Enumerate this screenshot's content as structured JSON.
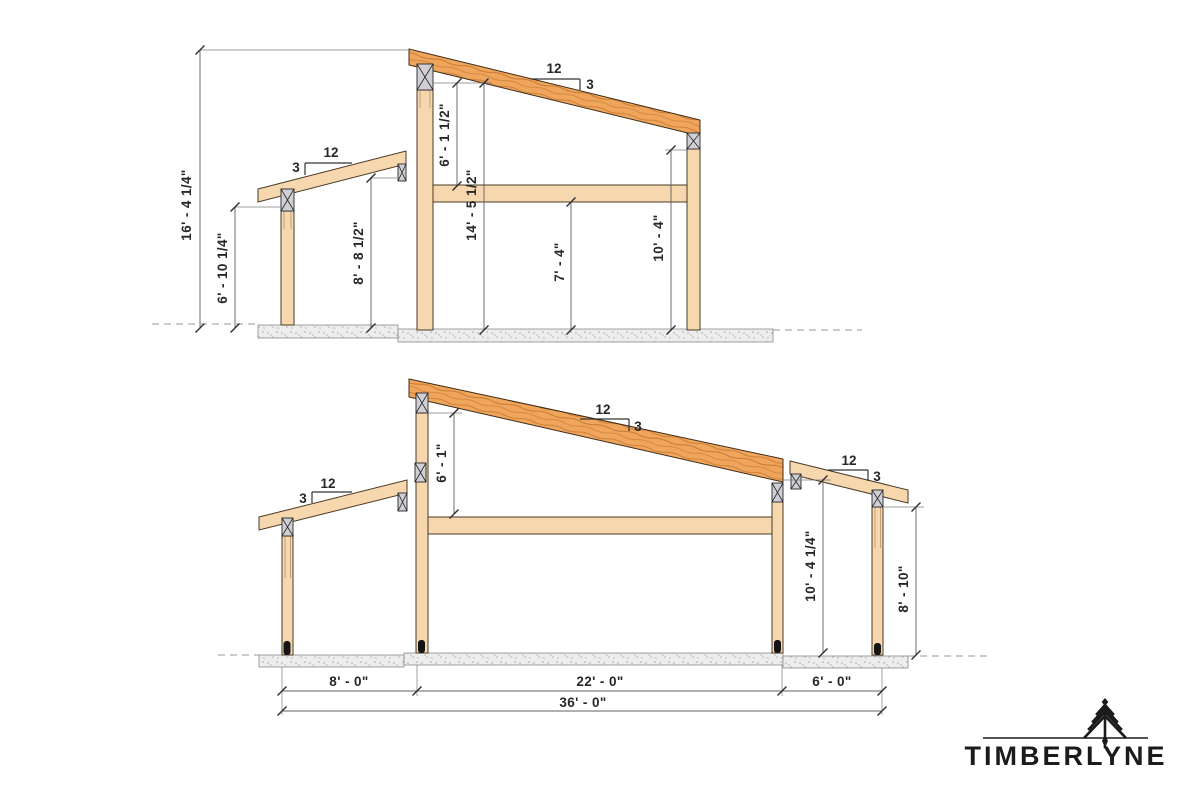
{
  "brand": {
    "name": "TIMBERLYNE"
  },
  "top_section": {
    "dims": {
      "overall_height": "16' - 4 1/4\"",
      "porch_post_height": "6' - 10 1/4\"",
      "porch_rafter_height": "8' - 8 1/2\"",
      "post_top_to_beam": "6' - 1 1/2\"",
      "main_post_height": "14' - 5 1/2\"",
      "beam_clear_height": "7' - 4\"",
      "right_post_height": "10' - 4\""
    },
    "slopes": {
      "main_rise": "12",
      "main_run": "3",
      "lean_rise": "12",
      "lean_run": "3"
    }
  },
  "bottom_section": {
    "dims": {
      "post_top_to_beam": "6' - 1\"",
      "right_main_post_height": "10' - 4 1/4\"",
      "right_porch_post_height": "8' - 10\"",
      "bay_left": "8' - 0\"",
      "bay_main": "22' - 0\"",
      "bay_right": "6' - 0\"",
      "overall_width": "36' - 0\""
    },
    "slopes": {
      "left_rise": "12",
      "left_run": "3",
      "main_rise": "12",
      "main_run": "3",
      "right_rise": "12",
      "right_run": "3"
    }
  },
  "colors": {
    "timber_fill": "#f6d7ae",
    "rafter_fill": "#f0a55c",
    "plate_fill": "#cfcfd4",
    "dim_line": "#606062",
    "text": "#272727",
    "logo": "#1b1b1b"
  }
}
